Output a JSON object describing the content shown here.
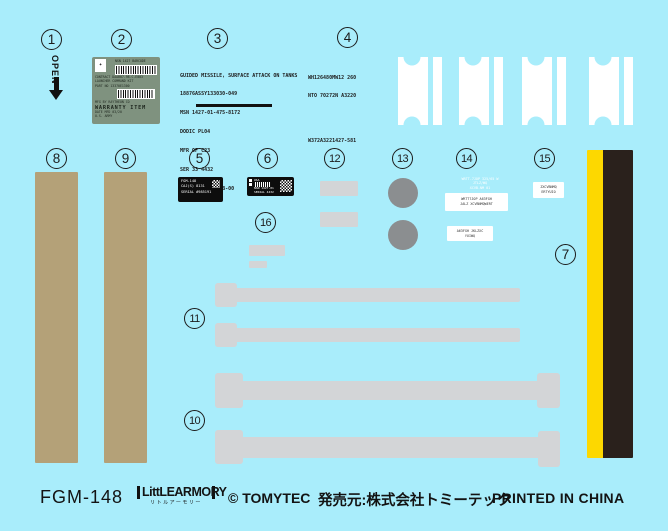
{
  "colors": {
    "background": "#a9edfb",
    "tan_strip": "#b4a178",
    "grey_decal": "#d3d5d7",
    "grey_dot": "#8b8e90",
    "stripe_yellow": "#fdd800",
    "stripe_black": "#2a211c",
    "warranty_label_green": "#7f927f",
    "label_black": "#0d0d0d"
  },
  "markers": {
    "m1": "1",
    "m2": "2",
    "m3": "3",
    "m4": "4",
    "m5": "5",
    "m6": "6",
    "m7": "7",
    "m8": "8",
    "m9": "9",
    "m10": "10",
    "m11": "11",
    "m12": "12",
    "m13": "13",
    "m14": "14",
    "m15": "15",
    "m16": "16"
  },
  "decal_open": {
    "label": "OPEN"
  },
  "decal_warranty_label": {
    "emblem": "✦",
    "header": "NSN 1427 BARCODE",
    "line_contract": "CONTRACT DAAB07-98-C-E003",
    "line_name": "LAUNCHER COMMAND KIT",
    "line_part": "PART NO   13370E1300",
    "line_mfg": "MFG BY    RAYTHEON CO",
    "warranty": "WARRANTY ITEM",
    "line_date": "DATE MFD  03/20",
    "line_us": "U.S. ARMY"
  },
  "decal_data_plate": {
    "lines": [
      "GUIDED MISSILE, SURFACE ATTACK ON TANKS",
      "18876ASSY133030-049",
      "MSN 1427-01-475-8172",
      "DODIC PL04",
      "MFR OF C23",
      "SER 33 4432",
      "LOT   WGP0GDQ2B-00"
    ]
  },
  "decal_stencil": {
    "line1": "WH126480MW12 260",
    "line2": "NTO 70272N A3220",
    "line3": "W372A3221427-581"
  },
  "decal_cage_label": {
    "line1": "FGM-148",
    "line2": "CAJ(S) 8131",
    "line3": "SERIAL #985191"
  },
  "decal_barcode_label": {
    "line1": "USA",
    "line2": "NSN 1427-01",
    "line3": "SERIAL 4432"
  },
  "decal_spec_white_text": {
    "line1": "WRTT-7JOP 325/65 W",
    "line2": "JTLZ/WQ",
    "line3": "XCVB-NM 01"
  },
  "decal_spec_label_1": {
    "line1": "WRTT7JOP A63FGH",
    "line2": "JALZ XCVBNMQWERT"
  },
  "decal_spec_label_2": {
    "line1": "A63FGH JKLZXC",
    "line2": "YUIWQ"
  },
  "decal_spec_label_3": {
    "line1": "ZXCVBNMQ",
    "line2": "ERTYUIO"
  },
  "footer": {
    "product_code": "FGM-148",
    "logo_main": "LittLEARMORY",
    "logo_sub": "リトルアーモリー",
    "copyright": "© TOMYTEC",
    "publisher": "発売元:株式会社トミーテック",
    "printed": "PRINTED IN CHINA"
  }
}
